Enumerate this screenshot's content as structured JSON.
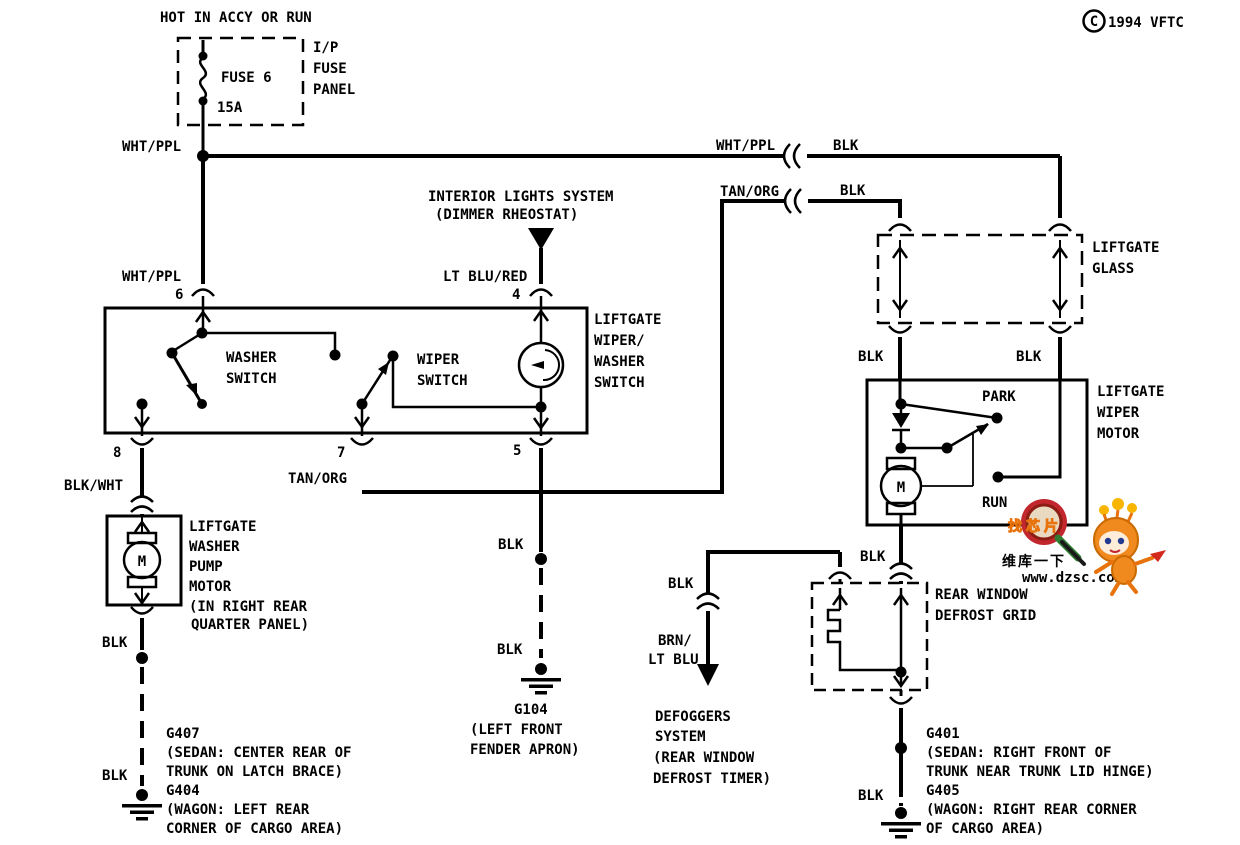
{
  "header": {
    "hot_label": "HOT IN ACCY OR RUN",
    "copyright_symbol": "C",
    "copyright_text": "1994 VFTC"
  },
  "fuse": {
    "name": "FUSE 6",
    "rating": "15A",
    "panel_lines": [
      "I/P",
      "FUSE",
      "PANEL"
    ]
  },
  "wire_labels": {
    "wht_ppl_top": "WHT/PPL",
    "wht_ppl_pin6": "WHT/PPL",
    "lt_blu_red": "LT BLU/RED",
    "wht_ppl_right": "WHT/PPL",
    "blk_right_top": "BLK",
    "tan_org_right": "TAN/ORG",
    "blk_right_2": "BLK",
    "blk_glass_left": "BLK",
    "blk_glass_right": "BLK",
    "blk_wht": "BLK/WHT",
    "tan_org_pin7": "TAN/ORG",
    "blk_pump_gnd": "BLK",
    "blk_g404": "BLK",
    "blk_pin5_upper": "BLK",
    "blk_pin5_lower": "BLK",
    "blk_defog": "BLK",
    "brn_lt_blu": [
      "BRN/",
      "LT BLU"
    ],
    "blk_motor_gnd": "BLK",
    "blk_g405": "BLK"
  },
  "interior_lights": {
    "lines": [
      "INTERIOR LIGHTS SYSTEM",
      "(DIMMER RHEOSTAT)"
    ]
  },
  "switch_box": {
    "label_lines": [
      "LIFTGATE",
      "WIPER/",
      "WASHER",
      "SWITCH"
    ],
    "washer_lines": [
      "WASHER",
      "SWITCH"
    ],
    "wiper_lines": [
      "WIPER",
      "SWITCH"
    ],
    "pins": {
      "p6": "6",
      "p4": "4",
      "p8": "8",
      "p7": "7",
      "p5": "5"
    }
  },
  "washer_pump": {
    "label_lines": [
      "LIFTGATE",
      "WASHER",
      "PUMP",
      "MOTOR",
      "(IN RIGHT REAR",
      "QUARTER PANEL)"
    ],
    "motor_letter": "M"
  },
  "liftgate_glass": {
    "label_lines": [
      "LIFTGATE",
      "GLASS"
    ]
  },
  "wiper_motor": {
    "label_lines": [
      "LIFTGATE",
      "WIPER",
      "MOTOR"
    ],
    "park": "PARK",
    "run": "RUN",
    "motor_letter": "M"
  },
  "defrost_grid": {
    "label_lines": [
      "REAR WINDOW",
      "DEFROST GRID"
    ]
  },
  "defoggers": {
    "lines": [
      "DEFOGGERS",
      "SYSTEM",
      "(REAR WINDOW",
      "DEFROST TIMER)"
    ]
  },
  "grounds": {
    "g104": {
      "lines": [
        "G104",
        "(LEFT FRONT",
        "FENDER APRON)"
      ]
    },
    "g407_g404": {
      "lines": [
        "G407",
        "(SEDAN: CENTER REAR OF",
        "TRUNK ON LATCH BRACE)",
        "G404",
        "(WAGON: LEFT REAR",
        "CORNER OF CARGO AREA)"
      ]
    },
    "g401_g405": {
      "lines": [
        "G401",
        "(SEDAN: RIGHT FRONT OF",
        "TRUNK NEAR TRUNK LID HINGE)",
        "G405",
        "(WAGON: RIGHT REAR CORNER",
        "OF CARGO AREA)"
      ]
    }
  },
  "watermark": {
    "badge_text": "找芯片",
    "brand_text": "维库一下",
    "url_text": "www.dzsc.com",
    "brand_color": "#e83a2f",
    "mascot_color": "#f0891e"
  }
}
